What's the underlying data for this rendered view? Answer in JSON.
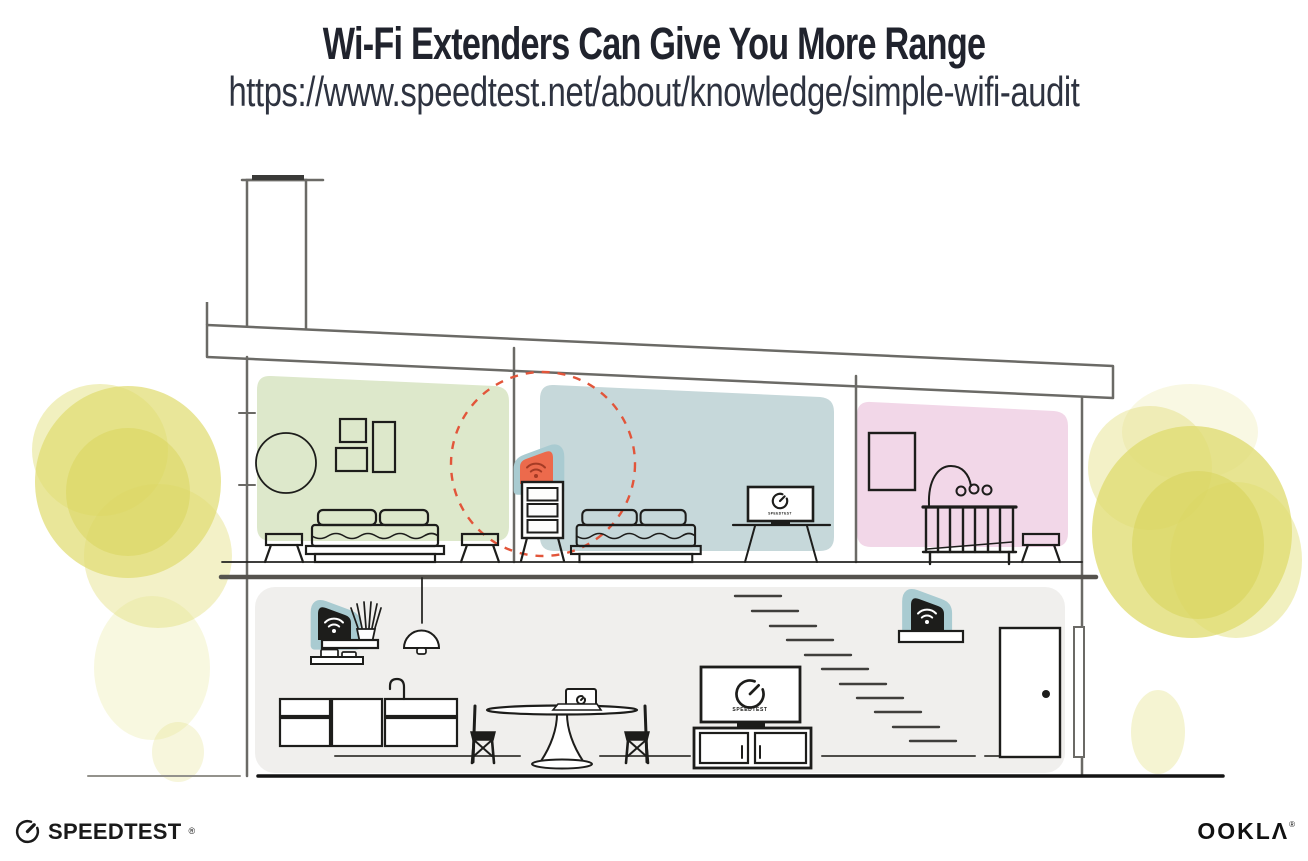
{
  "header": {
    "title": "Wi-Fi Extenders Can Give You More Range",
    "url": "https://www.speedtest.net/about/knowledge/simple-wifi-audit"
  },
  "branding": {
    "speedtest_wordmark": "SPEEDTEST",
    "speedtest_reg": "®",
    "ookla_wordmark": "OOKLΛ",
    "ookla_reg": "®"
  },
  "illustration": {
    "screen_label": "SPEEDTEST",
    "colors": {
      "room_green": "#dde8cb",
      "room_blue": "#c6d8da",
      "room_pink": "#f2d7e8",
      "lower_floor": "#f0efed",
      "device_teal": "#a9cbd1",
      "extender_orange": "#ec6a4c",
      "extender_wifi": "#a53b25",
      "range_circle": "#e2553a",
      "bush_yellow": "#e0dd72",
      "bush_core": "#d6d254",
      "structure": "#6b6a66",
      "ink": "#1d1d1b"
    },
    "rooms": {
      "green_bedroom": [
        "round mirror",
        "three wall frames",
        "double bed",
        "two stools"
      ],
      "blue_bedroom": [
        "dresser with highlighted wi-fi extender",
        "double bed",
        "tv on stand"
      ],
      "pink_nursery": [
        "wall frame",
        "crib with mobile",
        "stool"
      ],
      "ground_floor": [
        "wall shelf with wi-fi router",
        "plant sticks",
        "cup shelf",
        "pendant lamp",
        "kitchen cabinets with faucet",
        "dining table with laptop",
        "two chairs",
        "tv on media console",
        "staircase",
        "wall shelf with wi-fi extender",
        "front door"
      ]
    }
  }
}
